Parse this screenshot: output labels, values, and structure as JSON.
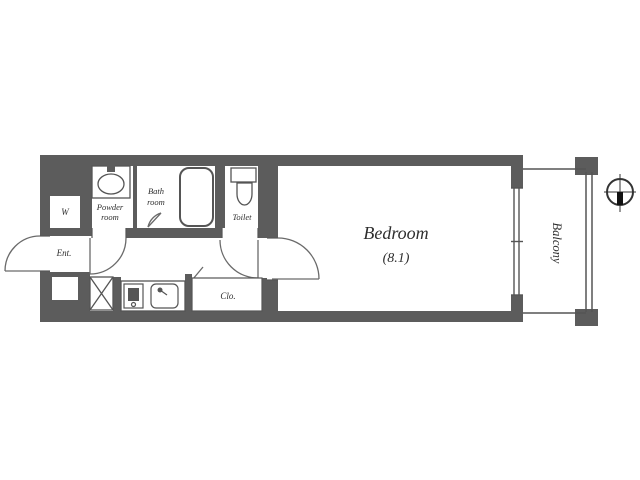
{
  "floorplan": {
    "title": "studio-apartment-floor-plan",
    "labels": {
      "bedroom_name": "Bedroom",
      "bedroom_size": "(8.1)",
      "balcony": "Balcony",
      "powder_room_line1": "Powder",
      "powder_room_line2": "room",
      "bath_room_line1": "Bath",
      "bath_room_line2": "room",
      "toilet": "Toilet",
      "entrance": "Ent.",
      "closet": "Clo.",
      "w_storage": "W"
    },
    "colors": {
      "wall": "#5c5c5c",
      "line": "#555555",
      "text": "#2e2e2e",
      "floor": "#ffffff",
      "compass_needle": "#111111"
    },
    "icons": {
      "compass-icon": "circle with crosshair, filled south needle",
      "bathtub-icon": "rounded rectangle tub",
      "toilet-icon": "tank and bowl",
      "washbasin-icon": "oval basin with tap",
      "stove-icon": "square burner unit",
      "sink-icon": "rounded sink with faucet",
      "washer-icon": "square with X"
    }
  }
}
